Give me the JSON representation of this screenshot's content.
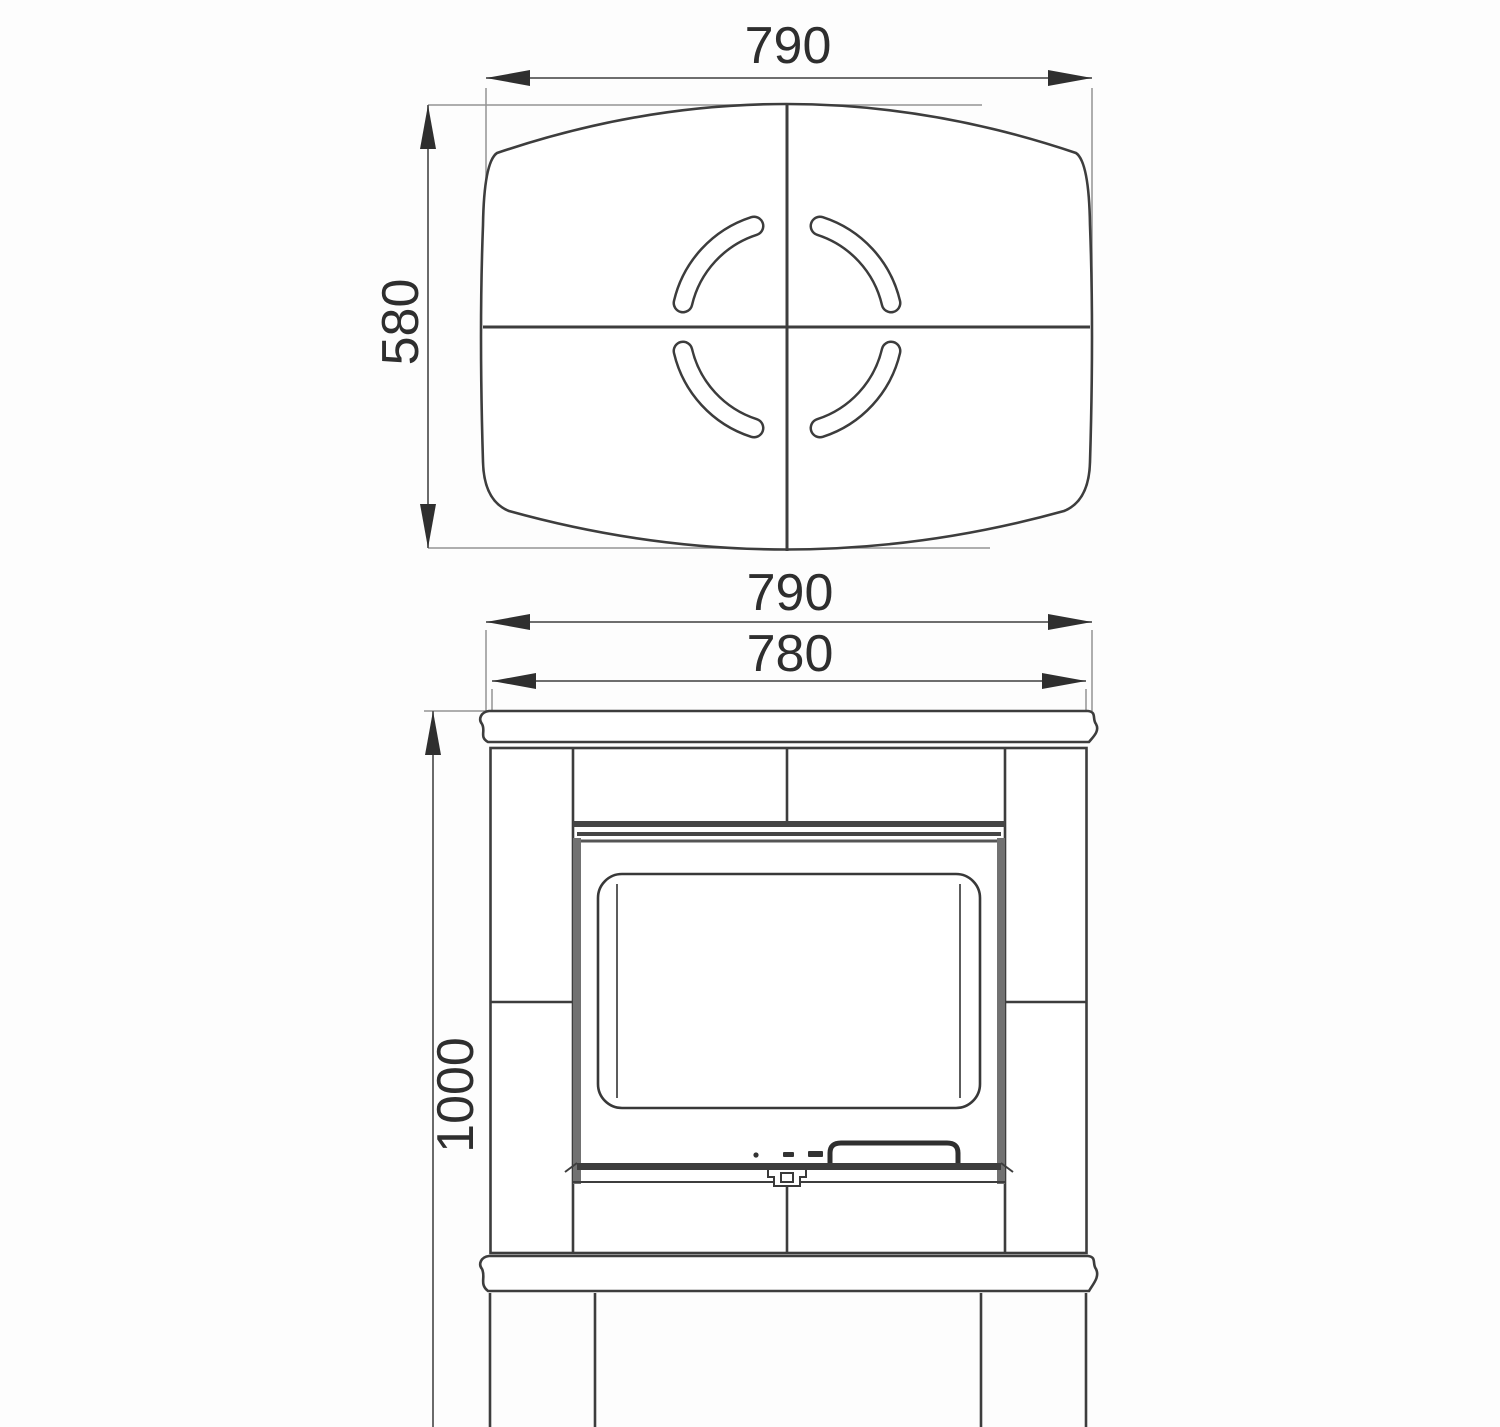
{
  "top_view": {
    "width_label": "790",
    "height_label": "580"
  },
  "front_view": {
    "top_width_label": "790",
    "body_width_label": "780",
    "height_label": "1000"
  }
}
